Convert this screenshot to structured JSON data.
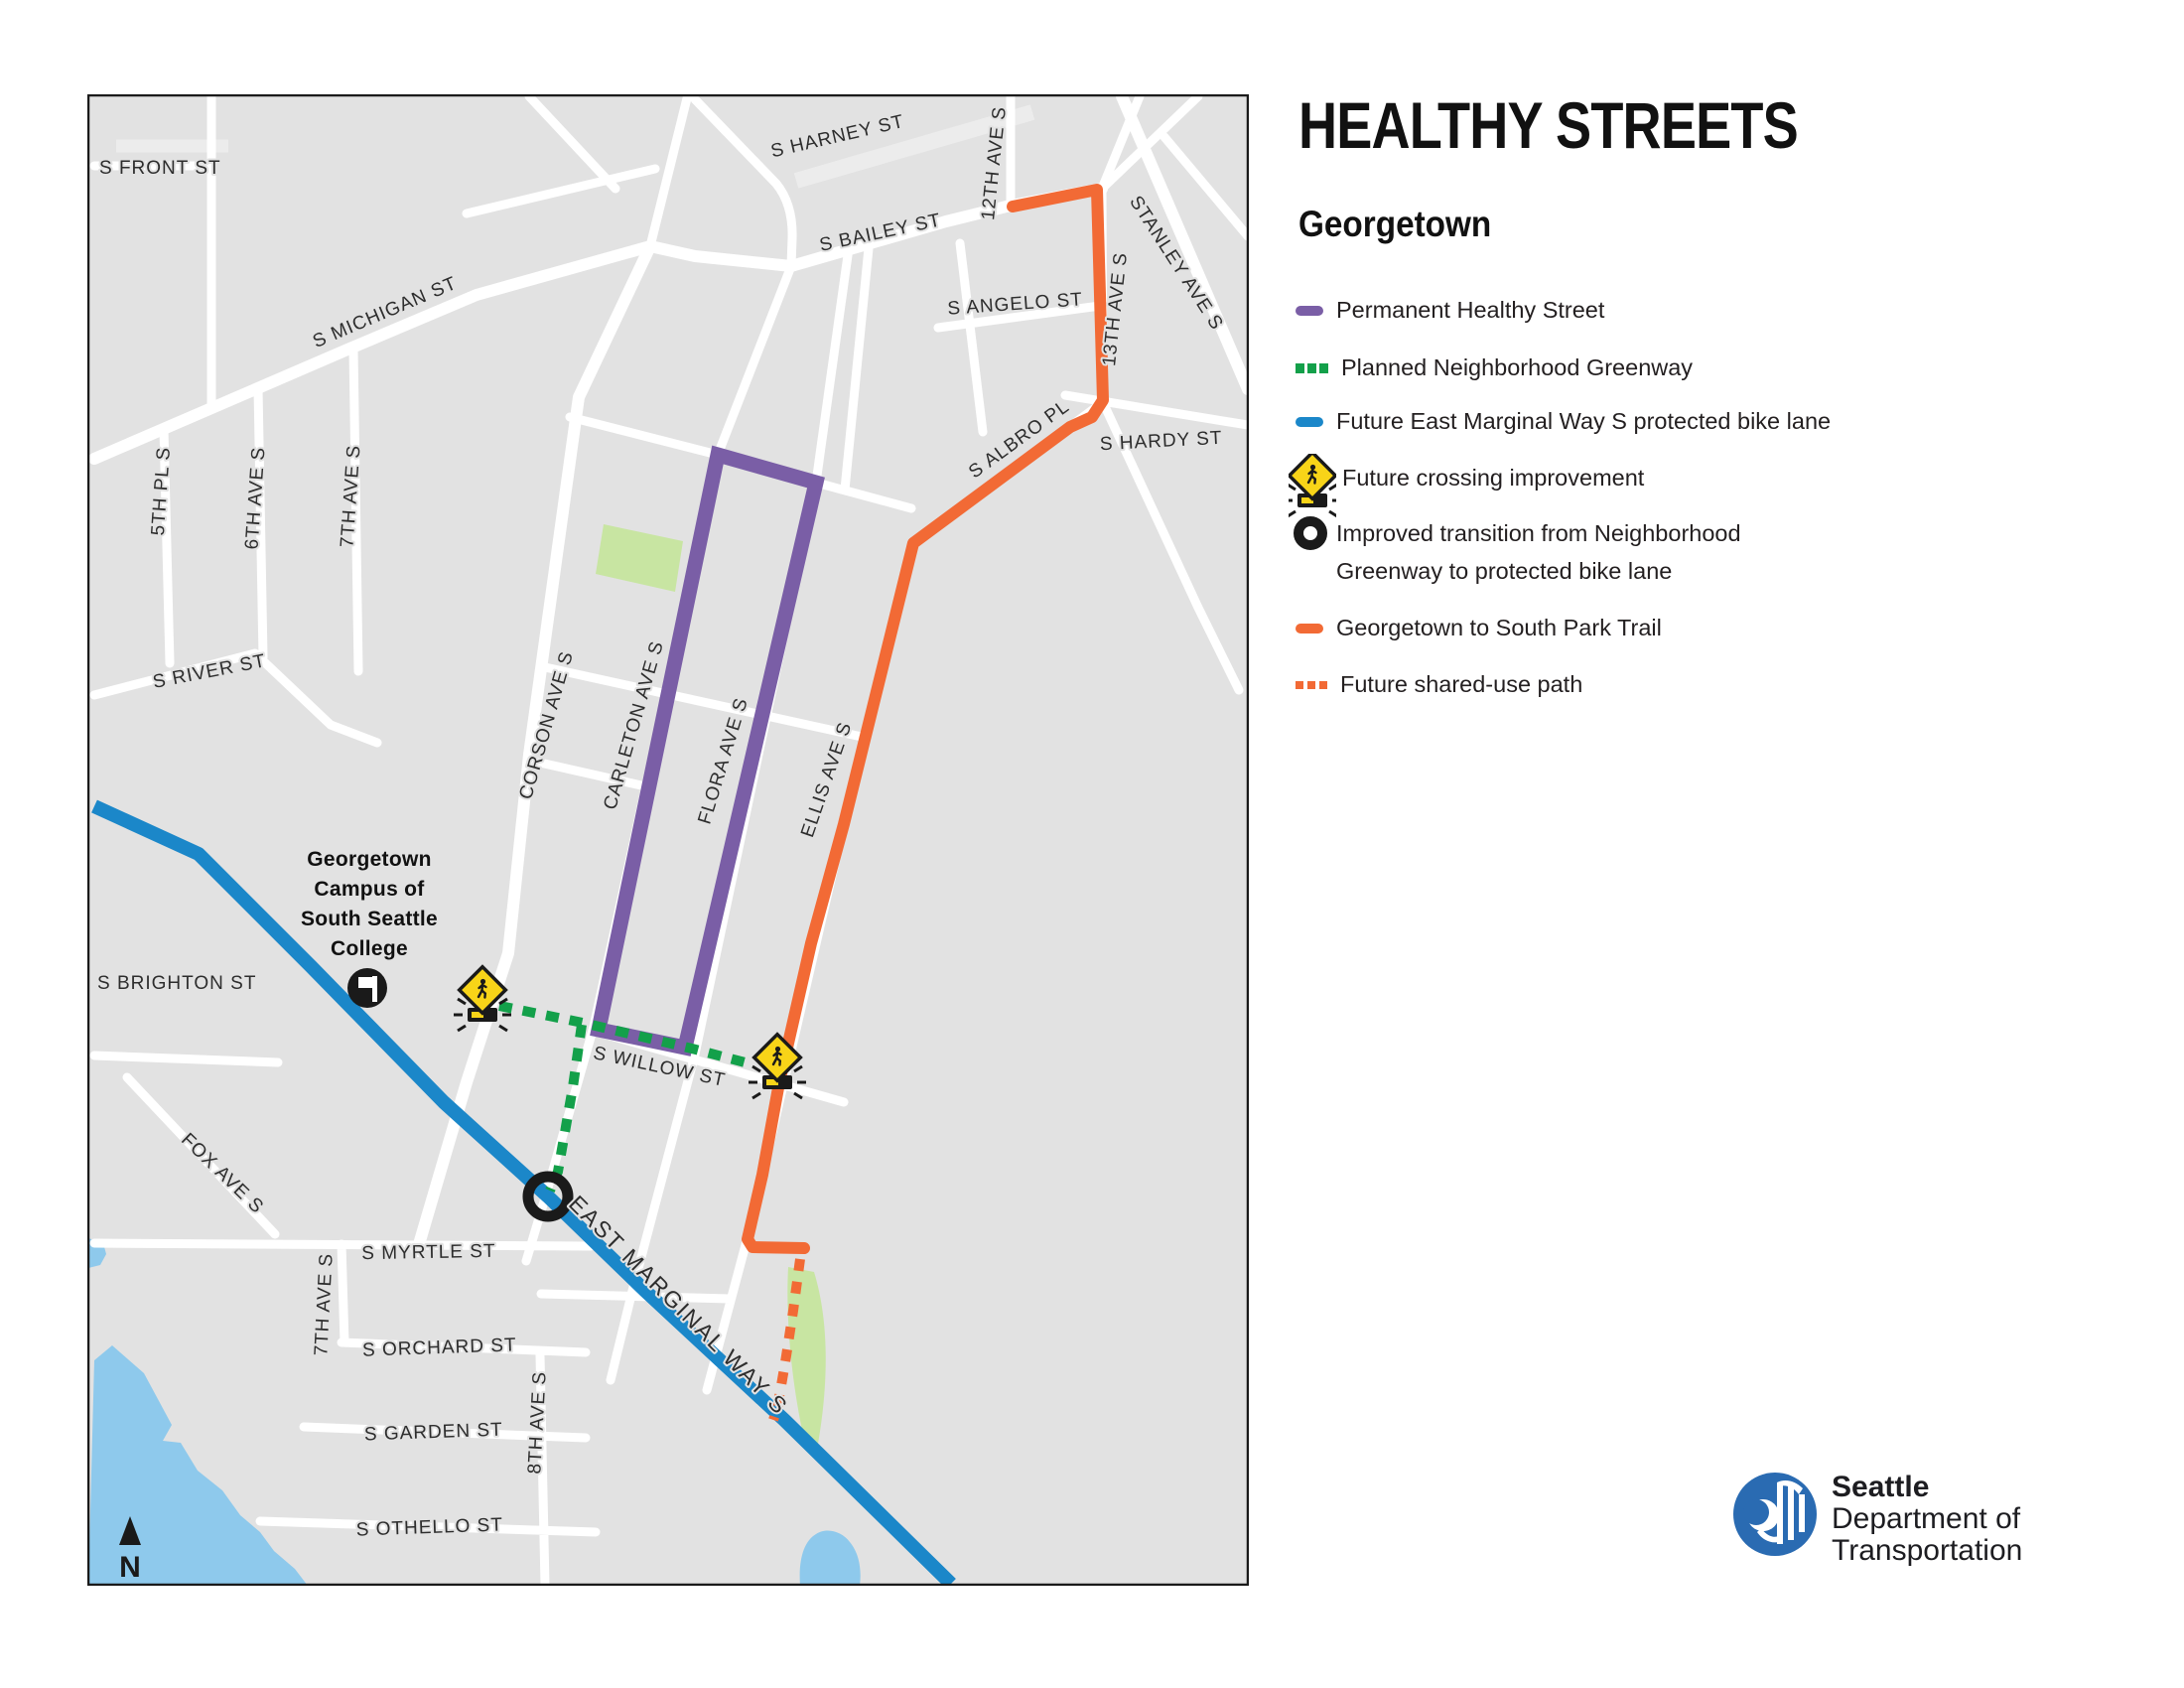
{
  "title": "HEALTHY STREETS",
  "subtitle": "Georgetown",
  "legend": {
    "items": [
      {
        "label": "Permanent Healthy Street",
        "type": "line",
        "color": "#7a5ea6"
      },
      {
        "label": "Planned Neighborhood Greenway",
        "type": "dashed",
        "color": "#13a04a"
      },
      {
        "label": "Future East Marginal Way S protected bike lane",
        "type": "line",
        "color": "#1b87c9"
      },
      {
        "label": "Future crossing improvement",
        "type": "crossing-icon"
      },
      {
        "label": "Improved transition from Neighborhood",
        "label2": "Greenway to protected bike lane",
        "type": "circle-icon"
      },
      {
        "label": "Georgetown to South Park Trail",
        "type": "line",
        "color": "#f26a35"
      },
      {
        "label": "Future shared-use path",
        "type": "dotted",
        "color": "#f26a35"
      }
    ]
  },
  "map": {
    "labels": {
      "front": "S FRONT ST",
      "michigan": "S MICHIGAN ST",
      "harney": "S HARNEY ST",
      "bailey": "S BAILEY ST",
      "angelo": "S ANGELO ST",
      "twelfth": "12TH AVE S",
      "stanley": "STANLEY AVE S",
      "thirteenth": "13TH AVE S",
      "albro": "S ALBRO PL",
      "hardy": "S HARDY ST",
      "fifth_pl": "5TH PL S",
      "sixth_ave": "6TH AVE S",
      "seventh_ave": "7TH AVE S",
      "river": "S RIVER ST",
      "corson": "CORSON AVE S",
      "carleton": "CARLETON AVE S",
      "flora": "FLORA AVE S",
      "ellis": "ELLIS AVE S",
      "brighton": "S BRIGHTON ST",
      "fox": "FOX AVE S",
      "myrtle": "S MYRTLE ST",
      "east_marginal": "EAST MARGINAL WAY S",
      "seventh_ave_s": "7TH AVE S",
      "orchard": "S ORCHARD ST",
      "garden": "S GARDEN ST",
      "eighth_ave": "8TH AVE S",
      "othello": "S OTHELLO ST",
      "willow": "S WILLOW ST"
    },
    "college": [
      "Georgetown",
      "Campus of",
      "South Seattle",
      "College"
    ],
    "north_label": "N"
  },
  "logo": {
    "line1": "Seattle",
    "line2": "Department of",
    "line3": "Transportation"
  },
  "colors": {
    "permanent_healthy_street": "#7a5ea6",
    "planned_greenway": "#13a04a",
    "protected_bike_lane": "#1b87c9",
    "trail_orange": "#f26a35",
    "crossing_yellow": "#f8d418",
    "park_green": "#c8e5a2",
    "water_blue": "#8ec9ec",
    "map_background": "#e2e2e2",
    "road_white": "#ffffff",
    "text_dark": "#231f20"
  }
}
